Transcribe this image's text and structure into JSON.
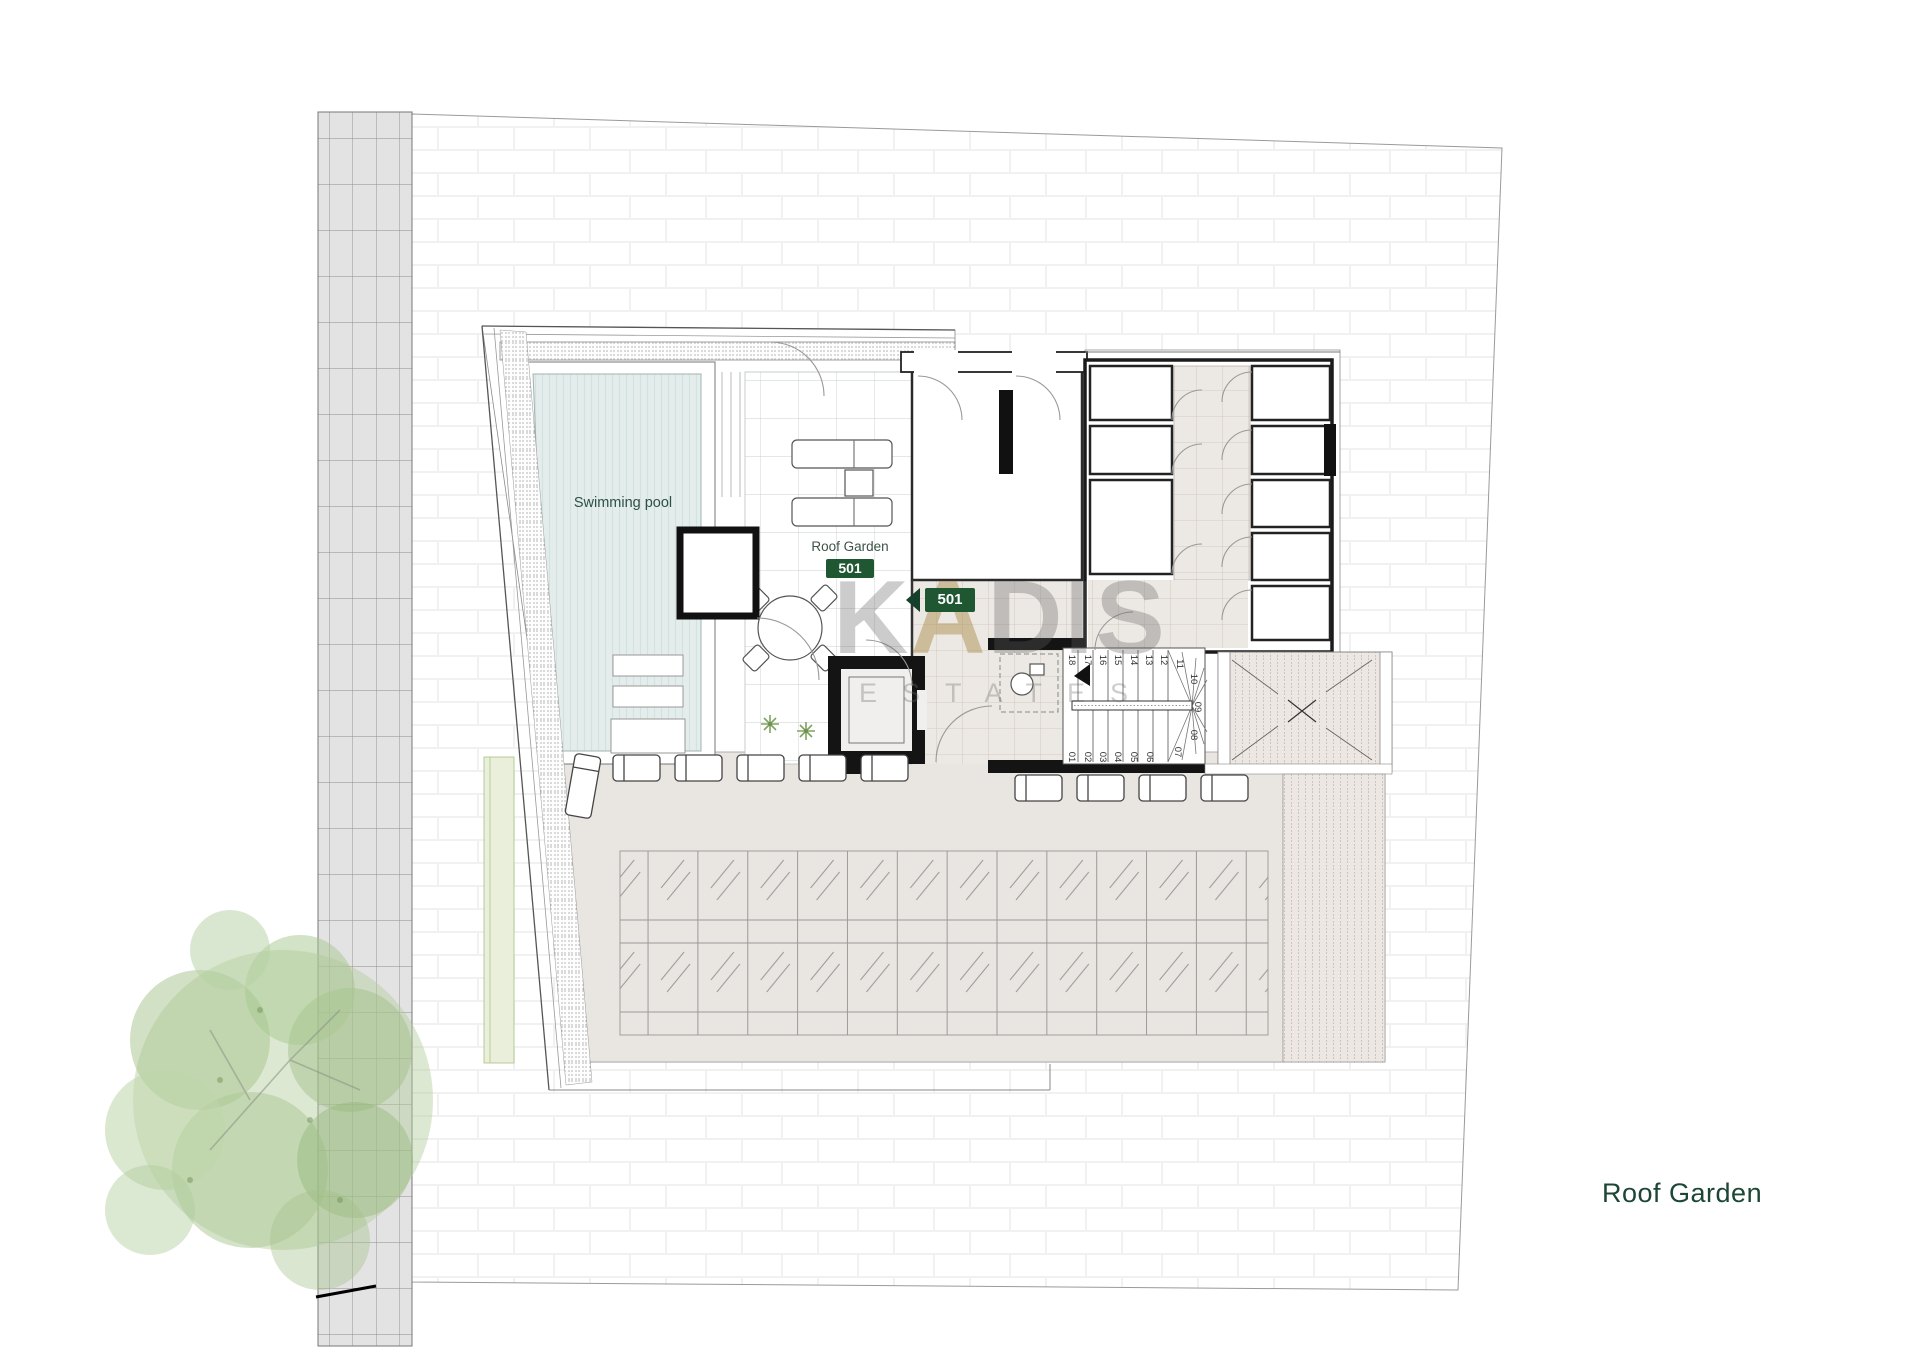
{
  "sheet": {
    "title": "Roof Garden"
  },
  "watermark": {
    "brand_k": "K",
    "brand_a": "A",
    "brand_dis": "DIS",
    "sub": "ESTATES"
  },
  "colors": {
    "badge_green": "#1f5733",
    "label_green": "#44564c",
    "title_green": "#1c4636",
    "pool_fill": "#e4edec",
    "terrace": "#e9e5e1",
    "corridor_tile": "#ece8e3",
    "road": "#e3e3e3",
    "wall_black": "#141414"
  },
  "pool": {
    "label": "Swimming pool"
  },
  "roof_garden": {
    "label": "Roof Garden",
    "unit": "501"
  },
  "entry_badge": {
    "unit": "501"
  },
  "storages": [
    {
      "label": "Storage",
      "number": "08",
      "unit": "302"
    },
    {
      "label": "Storage",
      "number": "09",
      "unit": "303"
    },
    {
      "label": "Storage",
      "number": "10",
      "unit": "401"
    },
    {
      "label": "Storage",
      "number": "11",
      "unit": "501"
    },
    {
      "label": "Storage",
      "number": "03",
      "unit": "101"
    },
    {
      "label": "Storage",
      "number": "04",
      "unit": "201"
    },
    {
      "label": "Storage",
      "number": "05",
      "unit": "202"
    },
    {
      "label": "Storage",
      "number": "06",
      "unit": "203"
    },
    {
      "label": "Storage",
      "number": "07",
      "unit": "301"
    }
  ],
  "stairs": {
    "treads": [
      "01",
      "02",
      "03",
      "04",
      "05",
      "06",
      "07",
      "08",
      "09",
      "10",
      "11",
      "12",
      "13",
      "14",
      "15",
      "16",
      "17",
      "18"
    ]
  }
}
